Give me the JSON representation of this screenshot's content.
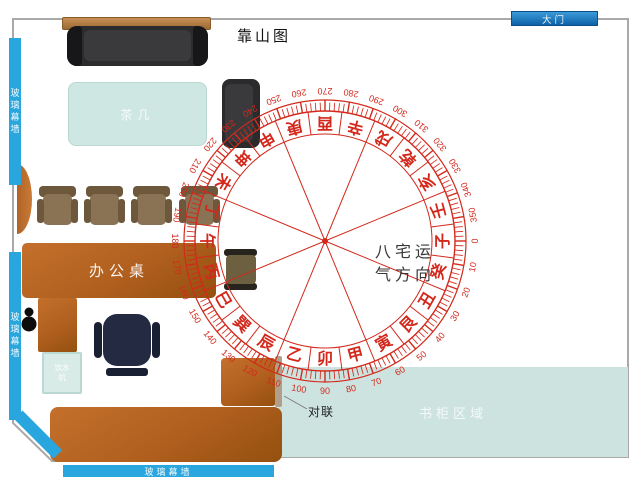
{
  "room": {
    "door_label": "大门",
    "backing_label": "靠山图",
    "glass_wall_left_top": "玻璃幕墙",
    "glass_wall_left_bottom": "玻璃幕墙",
    "glass_wall_bottom": "玻璃幕墙",
    "wall_color": "#a9a9a9",
    "glass_color": "#2aa6df"
  },
  "furniture": {
    "tea_table_label": "茶几",
    "desk_label": "办公桌",
    "dispenser_line1": "饮水",
    "dispenser_line2": "机",
    "couplet_label": "对联",
    "bookcase_area_label": "书柜区域"
  },
  "compass": {
    "center_text_line1": "八宅运",
    "center_text_line2": "气方向",
    "color": "#d3291c",
    "cx": 325,
    "cy": 241,
    "r_inner": 107,
    "r_ring": 130,
    "r_ticks": 141,
    "r_numbers": 150,
    "sector_count": 8,
    "sector_offset": 22.5,
    "mountains": [
      "子",
      "癸",
      "丑",
      "艮",
      "寅",
      "甲",
      "卯",
      "乙",
      "辰",
      "巽",
      "巳",
      "丙",
      "午",
      "丁",
      "未",
      "坤",
      "申",
      "庚",
      "酉",
      "辛",
      "戌",
      "乾",
      "亥",
      "壬"
    ],
    "degree_labels": [
      "0",
      "10",
      "20",
      "30",
      "40",
      "50",
      "60",
      "70",
      "80",
      "90",
      "100",
      "110",
      "120",
      "130",
      "140",
      "150",
      "160",
      "170",
      "180",
      "190",
      "200",
      "210",
      "220",
      "230",
      "240",
      "250",
      "260",
      "270",
      "280",
      "290",
      "300",
      "310",
      "320",
      "330",
      "340",
      "350"
    ]
  }
}
